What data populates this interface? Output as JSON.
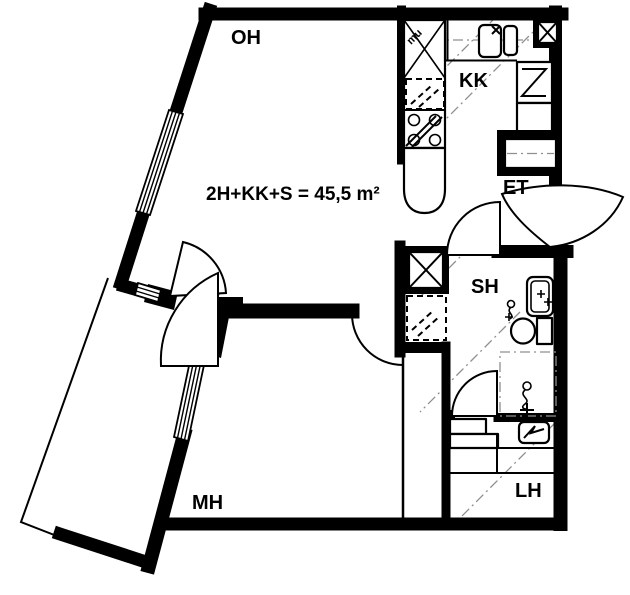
{
  "plan": {
    "area_label": "2H+KK+S = 45,5 m²",
    "rooms": [
      {
        "id": "oh",
        "label": "OH"
      },
      {
        "id": "kk",
        "label": "KK"
      },
      {
        "id": "et",
        "label": "ET"
      },
      {
        "id": "sh",
        "label": "SH"
      },
      {
        "id": "mh",
        "label": "MH"
      },
      {
        "id": "lh",
        "label": "LH"
      }
    ],
    "annotations": {
      "duct_note": "mu"
    },
    "colors": {
      "wall": "#000000",
      "background": "#ffffff",
      "guide": "#8f8f8f"
    }
  }
}
